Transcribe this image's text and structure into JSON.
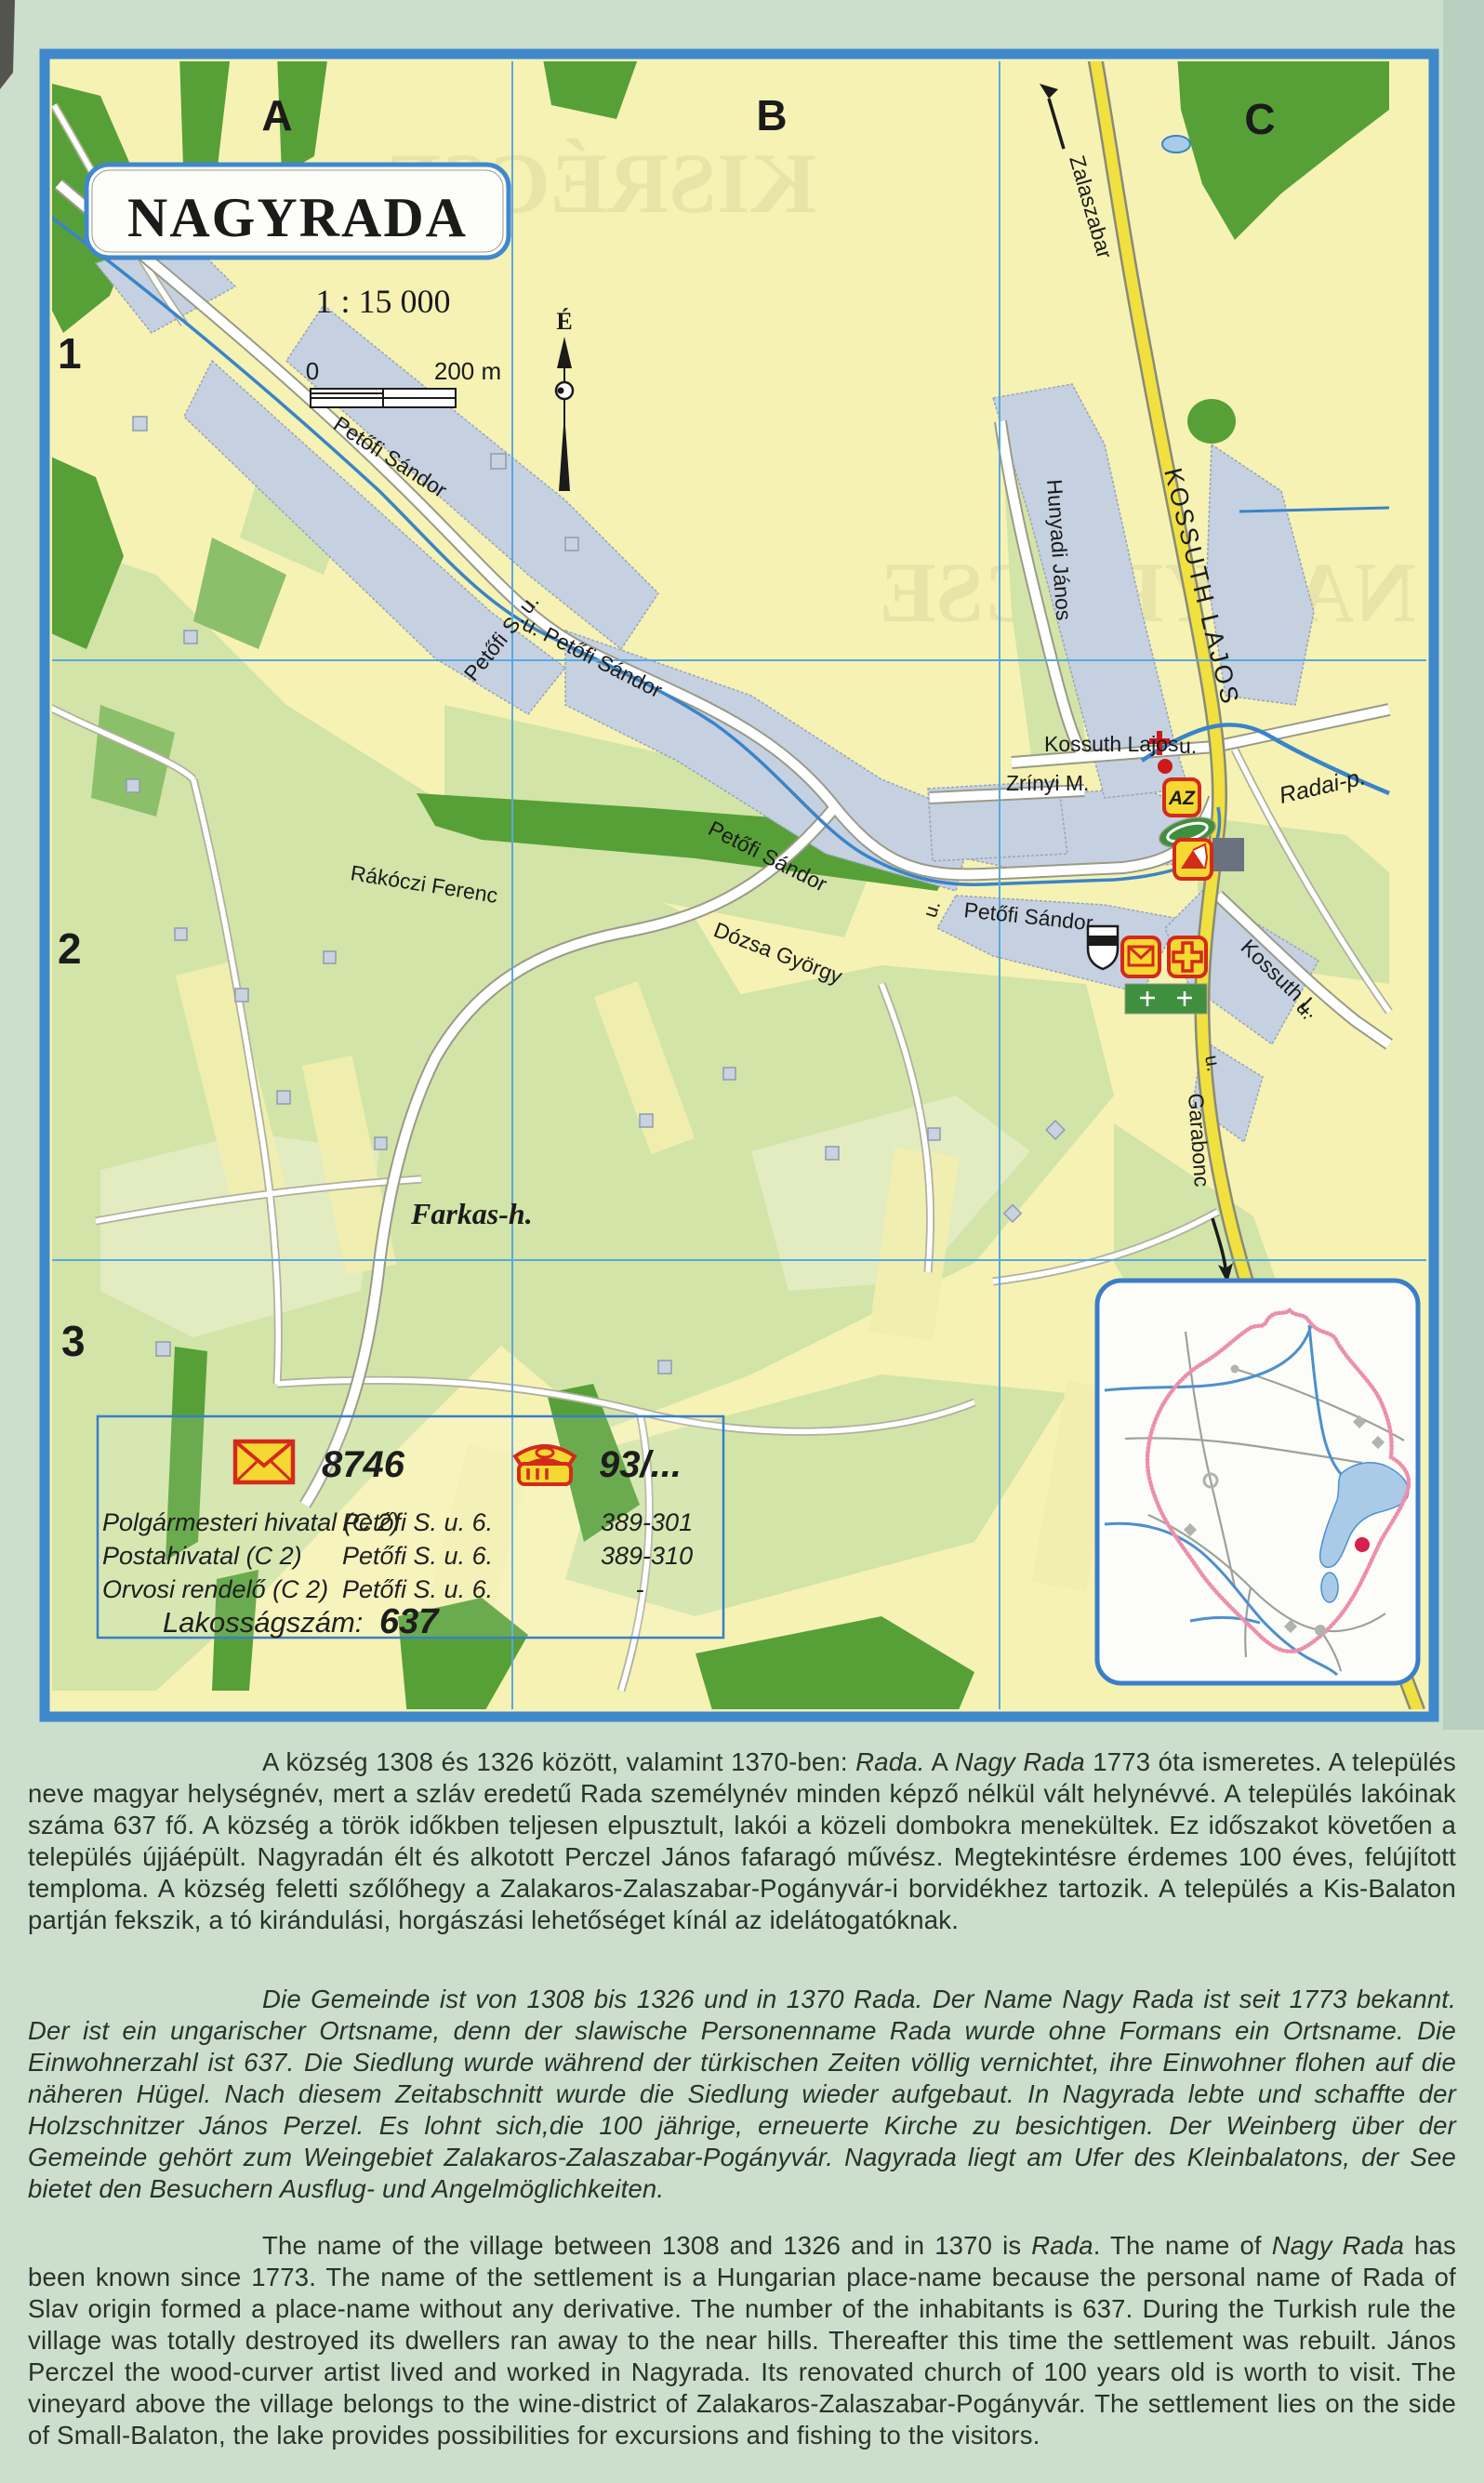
{
  "map": {
    "title": "NAGYRADA",
    "scale": "1 : 15 000",
    "scale_bar": {
      "zero": "0",
      "distance": "200 m"
    },
    "north_letter": "É",
    "grid": {
      "cols": [
        "A",
        "B",
        "C"
      ],
      "rows": [
        "1",
        "2",
        "3"
      ]
    },
    "streets": [
      {
        "text": "Petőfi Sándor"
      },
      {
        "text": "Petőfi S. u."
      },
      {
        "text": "u. Petőfi Sándor"
      },
      {
        "text": "Petőfi Sándor"
      },
      {
        "text": "u."
      },
      {
        "text": "Petőfi Sándor"
      },
      {
        "text": "Dózsa György"
      },
      {
        "text": "Rákóczi Ferenc"
      },
      {
        "text": "Hunyadi János"
      },
      {
        "text": "KOSSUTH LAJOS"
      },
      {
        "text": "Kossuth Lajos"
      },
      {
        "text": "u."
      },
      {
        "text": "Zrínyi M."
      },
      {
        "text": "Kossuth L."
      },
      {
        "text": "u."
      },
      {
        "text": "u."
      }
    ],
    "directions": {
      "north_road": "Zalaszabar",
      "south_road": "Garabonc"
    },
    "water": {
      "stream": "Radai-p."
    },
    "places": {
      "hill": "Farkas-h."
    },
    "poi": {
      "store_label": "AZ"
    },
    "show_through": {
      "top": "KISRÉCSE",
      "right": "NAGYRÉCSE"
    }
  },
  "legend": {
    "postal_code": "8746",
    "phone_prefix": "93/...",
    "rows": [
      {
        "name": "Polgármesteri hivatal (C 2)",
        "address": "Petőfi S. u. 6.",
        "phone": "389-301"
      },
      {
        "name": "Postahivatal (C 2)",
        "address": "Petőfi S. u. 6.",
        "phone": "389-310"
      },
      {
        "name": "Orvosi rendelő (C 2)",
        "address": "Petőfi S. u. 6.",
        "phone": "-"
      }
    ],
    "population_label": "Lakosságszám:",
    "population": "637"
  },
  "description": {
    "hungarian": {
      "seg1": "A község 1308 és 1326 között, valamint 1370-ben: ",
      "rada": "Rada.",
      "seg2": " A ",
      "nagyrada": "Nagy Rada",
      "seg3": " 1773 óta ismeretes. A település neve magyar helységnév, mert a szláv eredetű Rada személynév minden képző nélkül vált helynévvé. A település lakóinak száma 637 fő. A község a török időkben teljesen elpusztult, lakói a közeli dombokra menekültek. Ez időszakot követően a település újjáépült. Nagyradán élt és alkotott Perczel János fafaragó művész. Megtekintésre érdemes 100 éves, felújított temploma. A község feletti szőlőhegy  a Zalakaros-Zalaszabar-Pogányvár-i borvidékhez tartozik.  A település a Kis-Balaton partján fekszik, a tó kirándulási, horgászási lehetőséget kínál az idelátogatóknak."
    },
    "german": {
      "text": "Die Gemeinde ist von 1308 bis 1326 und in 1370 Rada. Der Name Nagy Rada ist seit 1773 bekannt. Der ist ein ungarischer Ortsname, denn der slawische Personenname Rada wurde ohne Formans ein Ortsname. Die Einwohnerzahl ist 637. Die Siedlung wurde während der türkischen Zeiten völlig vernichtet, ihre Einwohner flohen auf die näheren Hügel. Nach diesem Zeitabschnitt wurde die Siedlung wieder aufgebaut. In Nagyrada lebte und schaffte der Holzschnitzer János Perzel. Es lohnt sich,die 100 jährige, erneuerte Kirche zu besichtigen. Der Weinberg über der Gemeinde gehört zum Weingebiet Zalakaros-Zalaszabar-Pogányvár. Nagyrada liegt am Ufer des Kleinbalatons, der See bietet den Besuchern Ausflug- und Angelmöglichkeiten."
    },
    "english": {
      "seg1": "The name of the village between 1308 and 1326 and in 1370 is ",
      "rada": "Rada",
      "seg2": ". The name of ",
      "nagyrada": "Nagy Rada",
      "seg3": " has been known since 1773. The name of the settlement is a Hungarian place-name because the personal name of Rada of Slav origin formed a place-name without any derivative. The number of the inhabitants is 637. During the Turkish rule the village was totally destroyed its dwellers ran away to the near hills. Thereafter this time the settlement was rebuilt. János Perczel the wood-curver artist lived and worked in Nagyrada. Its renovated church of 100 years old is worth to visit. The vineyard above the village belongs to the wine-district of Zalakaros-Zalaszabar-Pogányvár. The settlement lies on the side of Small-Balaton, the lake provides possibilities for excursions and fishing to the visitors."
    }
  },
  "colors": {
    "map_border": "#3f88cc",
    "grid_line": "#58a8dc",
    "field_yellow": "#f5f2b4",
    "light_green": "#d2e4a8",
    "forest_green": "#57a037",
    "builtup": "#c5d1e1",
    "main_road_yellow": "#f0e040",
    "stream_blue": "#3a84c8",
    "poi_red": "#d42a1a",
    "poi_yellow": "#f5d832",
    "boundary_pink": "#ec8fac",
    "marker_red": "#d6214e",
    "page_bg": "#ccdfcc"
  }
}
